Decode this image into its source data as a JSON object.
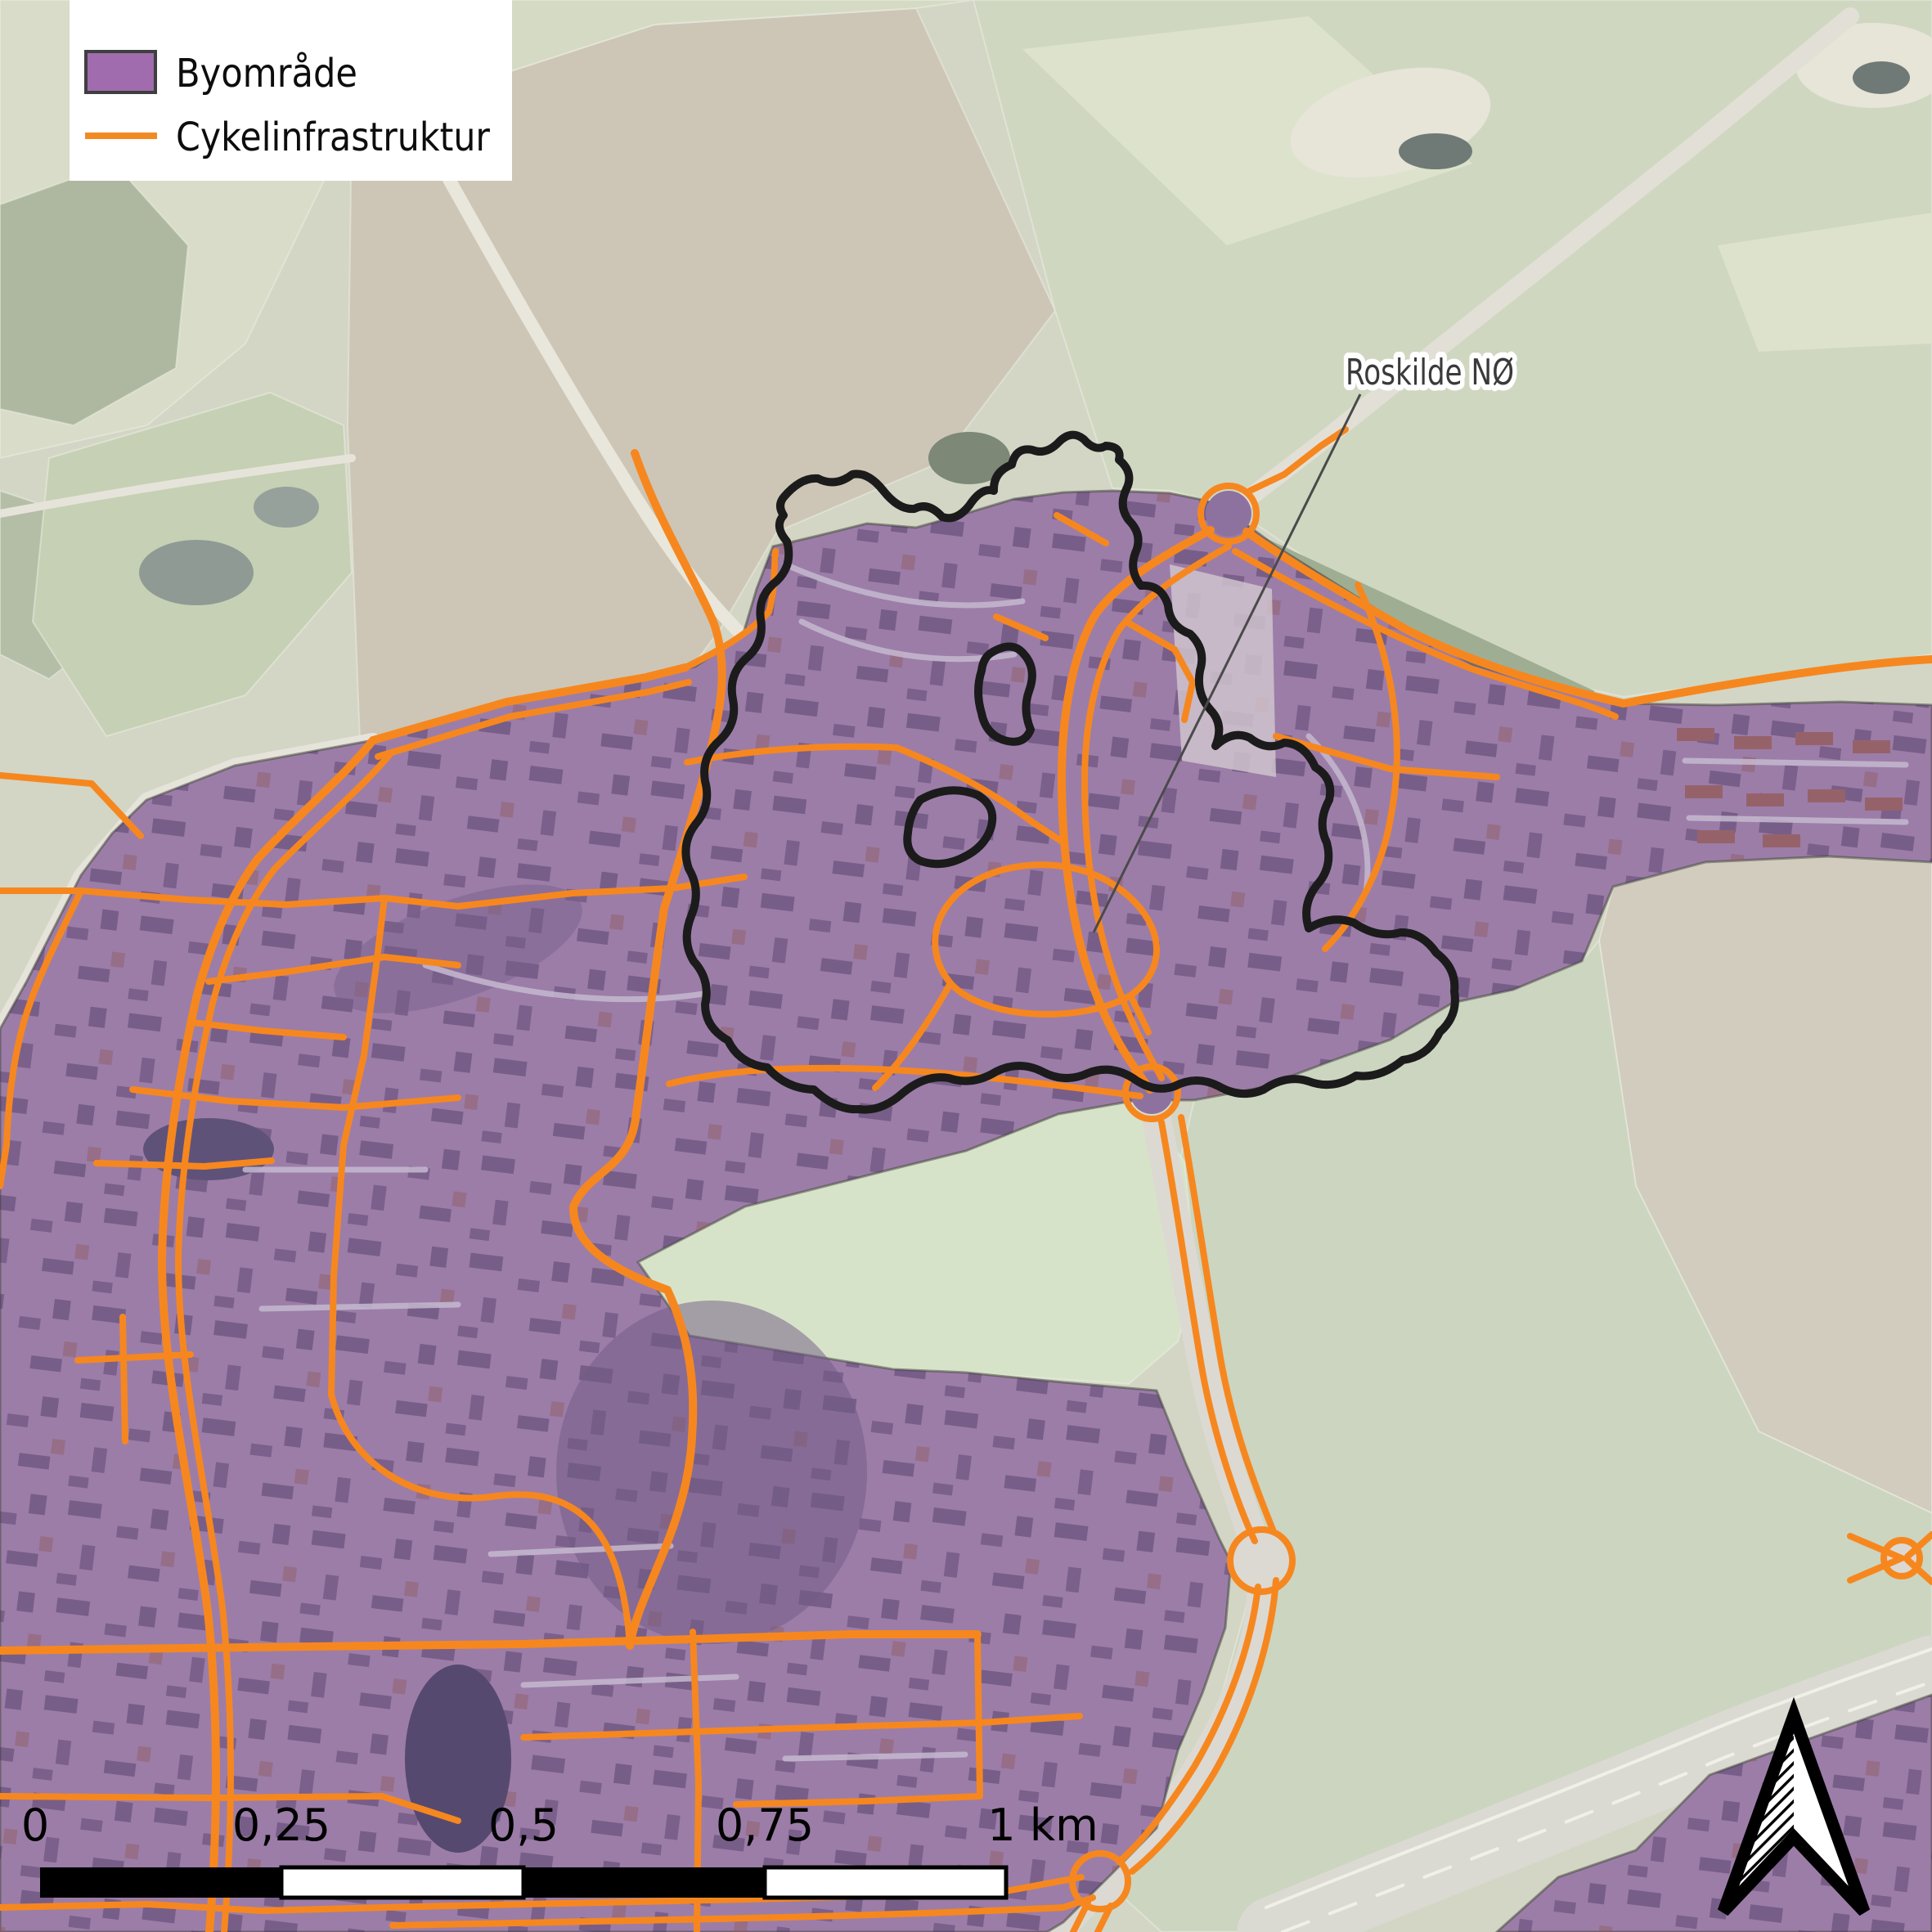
{
  "legend": {
    "items": [
      {
        "label": "Byområde",
        "swatch_color": "#a16cae",
        "swatch_border": "#3f3f3f",
        "type": "fill"
      },
      {
        "label": "Cykelinfrastruktur",
        "line_color": "#f28a24",
        "type": "line"
      }
    ]
  },
  "annotation": {
    "label": "Roskilde NØ"
  },
  "scalebar": {
    "labels": [
      "0",
      "0,25",
      "0,5",
      "0,75",
      "1 km"
    ],
    "unit": "km",
    "segments": 4
  },
  "map_colors": {
    "byomrade_fill": "#9c7da8",
    "cycle_line": "#f6871f",
    "annotation_outline": "#1b1b1b",
    "fields_green": "#cfd7c1",
    "fields_plowed": "#cdc6b6"
  }
}
